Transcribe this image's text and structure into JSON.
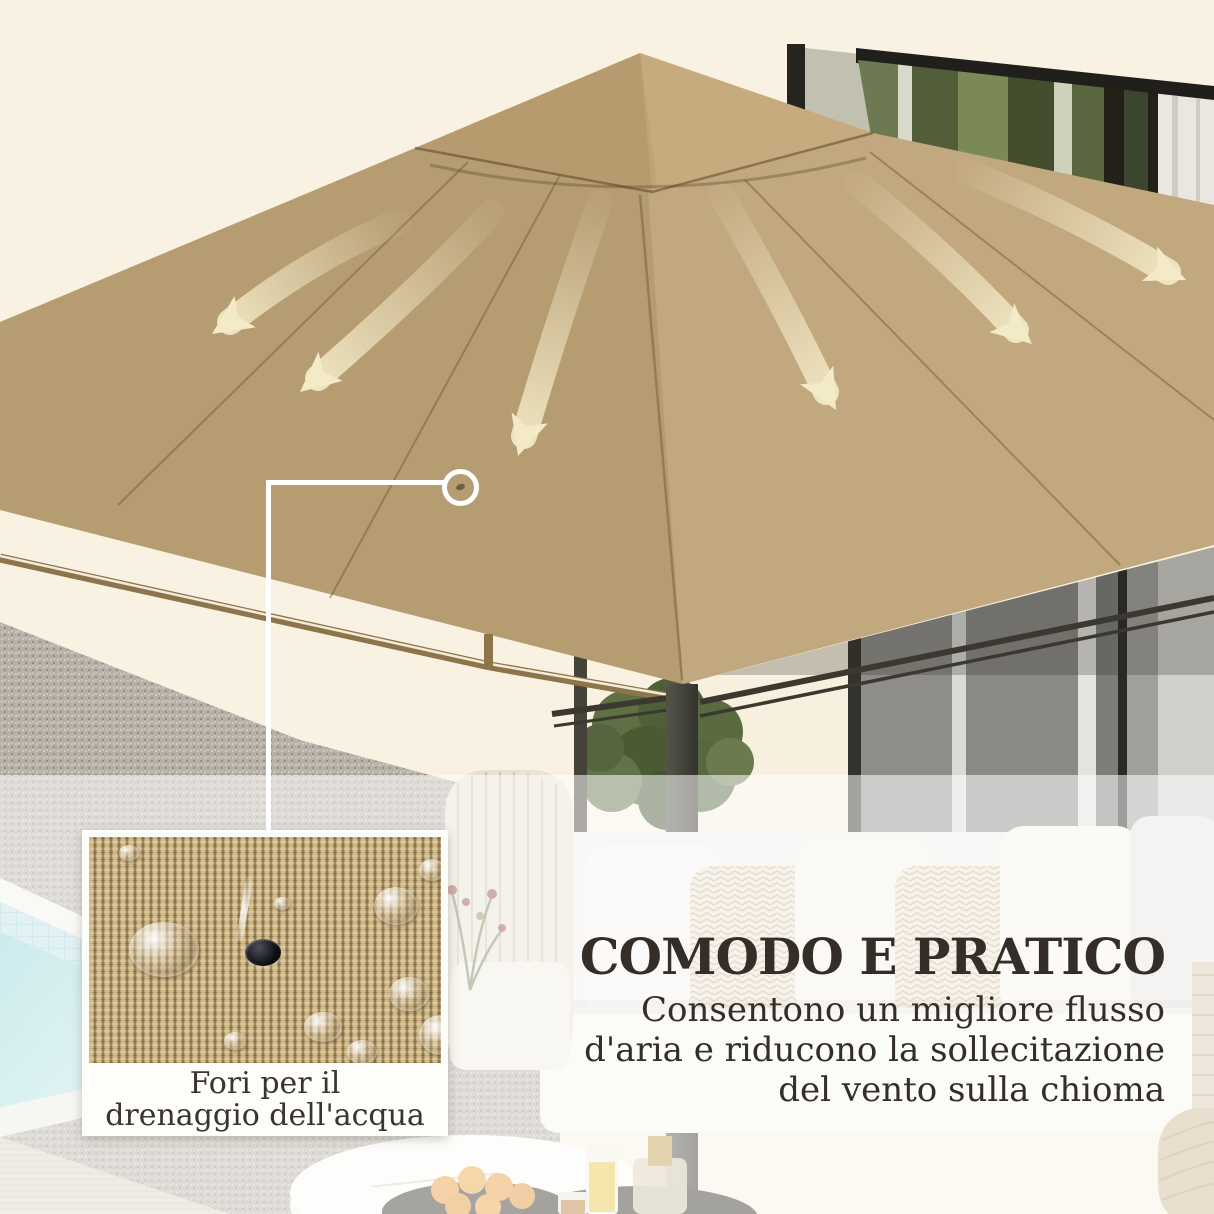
{
  "page": {
    "language": "it",
    "kind": "product-feature-image"
  },
  "headline": {
    "title": "COMODO E PRATICO",
    "lines": [
      "Consentono un migliore flusso",
      "d'aria e riducono la sollecitazione",
      "del vento sulla chioma"
    ]
  },
  "inset": {
    "caption": [
      "Fori per il",
      "drenaggio dell'acqua"
    ]
  },
  "annotations": {
    "callout_target": "drainage-hole-on-canopy",
    "airflow_arrows": {
      "left_count": 3,
      "right_count": 3
    }
  },
  "colors": {
    "background_cream": "#f9f2e2",
    "canopy_tan": "#bfa478",
    "arrow_cream": "#f3eac7",
    "text_dark": "#352e28",
    "callout_white": "#ffffff",
    "pool_aqua": "#9ed8da",
    "fabric_tan": "#b79d6c"
  }
}
